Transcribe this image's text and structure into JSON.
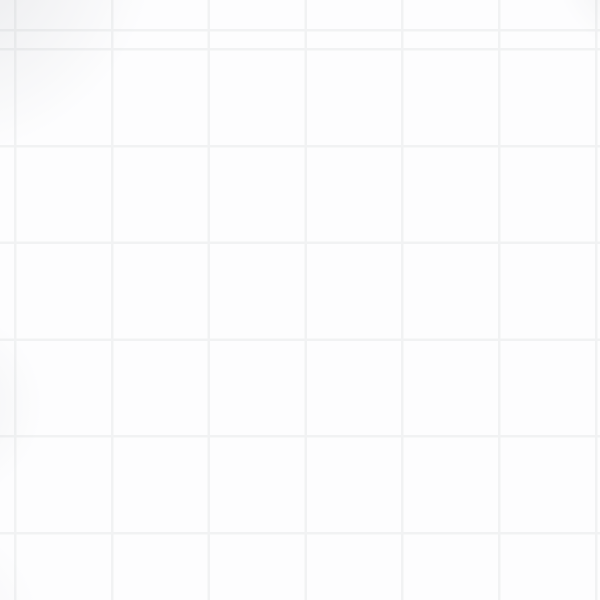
{
  "scene": {
    "width": 600,
    "height": 600,
    "background": {
      "color": "#fdfdfe",
      "grid_line_color": "#f1f2f3",
      "grid_line_width": 2.5,
      "grid_size": 96.8,
      "grid_offset_x": 14,
      "grid_offset_y": 48
    }
  },
  "road": {
    "path": "M 161.5 606 L 161.5 345.5 A 55 55 0 0 1 216.5 290.5 L 395 290.5 A 55 55 0 0 0 449.5 235.5 L 449.5 -6",
    "width": 74,
    "border_width": 79,
    "halo_width": 86,
    "fill_color": "#ced0d7",
    "border_color": "#9a9ba2",
    "halo_color": "rgba(125,130,145,0.12)"
  },
  "arrows": {
    "color": "#c1c3cb",
    "base": 28,
    "depth": 17,
    "items": [
      {
        "x": 161.5,
        "y": 604,
        "rot": 0
      },
      {
        "x": 161.5,
        "y": 572,
        "rot": 0
      },
      {
        "x": 161.5,
        "y": 540,
        "rot": 0
      },
      {
        "x": 161.5,
        "y": 508,
        "rot": 0
      },
      {
        "x": 161.5,
        "y": 476,
        "rot": 0
      },
      {
        "x": 161.5,
        "y": 444,
        "rot": 0
      },
      {
        "x": 161.5,
        "y": 412,
        "rot": 0
      },
      {
        "x": 161.5,
        "y": 380,
        "rot": 0
      },
      {
        "x": 161.5,
        "y": 348,
        "rot": 0
      },
      {
        "x": 169,
        "y": 316,
        "rot": 33
      },
      {
        "x": 192,
        "y": 296,
        "rot": 64
      },
      {
        "x": 203,
        "y": 290.5,
        "rot": 90
      },
      {
        "x": 235,
        "y": 290.5,
        "rot": 90
      },
      {
        "x": 267,
        "y": 290.5,
        "rot": 90
      },
      {
        "x": 299,
        "y": 290.5,
        "rot": 90
      },
      {
        "x": 331,
        "y": 290.5,
        "rot": 90
      },
      {
        "x": 363,
        "y": 290.5,
        "rot": 90
      },
      {
        "x": 395,
        "y": 290.5,
        "rot": 90
      },
      {
        "x": 424.5,
        "y": 282.5,
        "rot": 57
      },
      {
        "x": 445.5,
        "y": 258.5,
        "rot": 25
      },
      {
        "x": 449.5,
        "y": 226,
        "rot": 0
      },
      {
        "x": 449.5,
        "y": 194,
        "rot": 0
      },
      {
        "x": 449.5,
        "y": 162,
        "rot": 0
      },
      {
        "x": 449.5,
        "y": 130,
        "rot": 0
      },
      {
        "x": 449.5,
        "y": 98,
        "rot": 0
      },
      {
        "x": 449.5,
        "y": 66,
        "rot": 0
      },
      {
        "x": 449.5,
        "y": 34,
        "rot": 0
      },
      {
        "x": 449.5,
        "y": 2,
        "rot": 0
      }
    ]
  },
  "crates": {
    "size": 53,
    "fill_color": "#a8a9a6",
    "border_color": "#5c5e62",
    "border_width": 3.5,
    "divider_width": 3,
    "corner_radius": 2,
    "shadow_color": "rgba(122,126,140,0.28)",
    "shadow_radius": 32,
    "items": [
      {
        "x": 451,
        "y": 60
      },
      {
        "x": 443.5,
        "y": 269.5
      },
      {
        "x": 240,
        "y": 291
      },
      {
        "x": 161.5,
        "y": 444.5
      }
    ]
  }
}
